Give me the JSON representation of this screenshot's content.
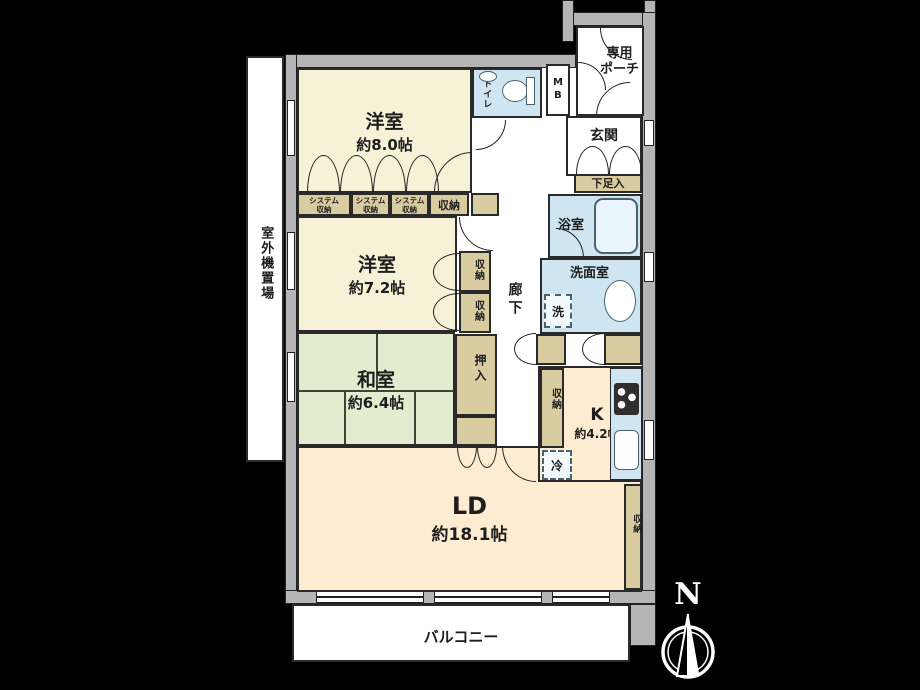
{
  "floorplan": {
    "rooms": {
      "bedroom8": {
        "name": "洋室",
        "size": "約8.0帖"
      },
      "bedroom72": {
        "name": "洋室",
        "size": "約7.2帖"
      },
      "washitsu": {
        "name": "和室",
        "size": "約6.4帖"
      },
      "living_dining": {
        "name": "LD",
        "size": "約18.1帖"
      },
      "kitchen": {
        "name": "K",
        "size": "約4.2帖"
      },
      "entrance": {
        "name": "玄関"
      },
      "porch": {
        "name": "専用\nポーチ"
      },
      "toilet": {
        "name": "トイレ"
      },
      "bathroom": {
        "name": "浴室"
      },
      "washroom": {
        "name": "洗面室"
      },
      "hallway": {
        "name": "廊下"
      },
      "balcony": {
        "name": "バルコニー"
      },
      "outdoor_unit_area": {
        "name": "室外機置場"
      }
    },
    "fixtures": {
      "meter_box": "M\nB",
      "shoe_cabinet": "下足入",
      "system_storage": "システム\n収納",
      "storage": "収納",
      "oshiire": "押入",
      "washer": "洗",
      "fridge": "冷"
    },
    "compass": {
      "north_label": "N"
    },
    "colors": {
      "background": "#000000",
      "wall": "#b5b5b5",
      "western_room_floor": "#f7f1d7",
      "ld_kitchen_floor": "#fdecd2",
      "tatami_floor": "#e2ecce",
      "storage": "#d9cca1",
      "wet_area": "#cfe6f2",
      "balcony": "#ffffff",
      "outline": "#222222",
      "compass": "#ffffff"
    }
  }
}
